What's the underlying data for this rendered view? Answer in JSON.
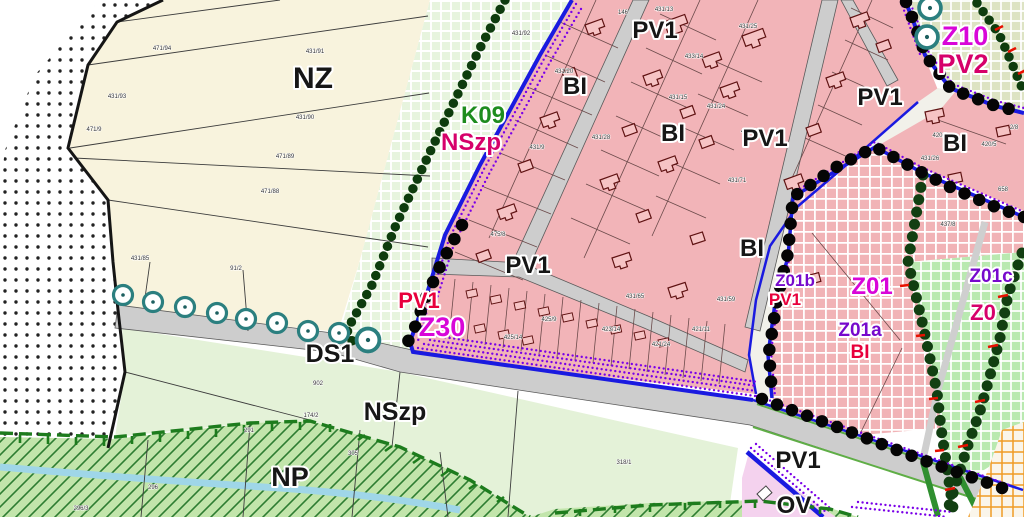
{
  "palette": {
    "pink_zone": "#f2b4b8",
    "cream_zone": "#f8f3dd",
    "green_grid_zone": "#e7f4de",
    "olive_grid_zone": "#dde3c3",
    "bright_green_zone": "#b9e9b0",
    "light_green_zone": "#e4f2d8",
    "hatch_zone": "#c2e5ab",
    "road_gray": "#cdcdcd",
    "boundary_blue": "#1a1ae0",
    "boundary_purple": "#7a00e8",
    "bead_green": "#0e3c0e",
    "tree_teal": "#2b7f7f",
    "tick_red": "#e81000",
    "label_green": "#1e8c1e",
    "label_magenta": "#d806d8",
    "label_crimson": "#d6006a",
    "label_red": "#e8003c",
    "label_purple": "#7709cc",
    "orange_grid": "#ef9b25",
    "stream_blue": "#9fd6e8"
  },
  "zone_labels": [
    {
      "id": "nz",
      "text": "NZ"
    },
    {
      "id": "k09",
      "text": "K09"
    },
    {
      "id": "nszp-colored",
      "text": "NSzp"
    },
    {
      "id": "bi-1",
      "text": "BI"
    },
    {
      "id": "pv1-top",
      "text": "PV1"
    },
    {
      "id": "bi-2",
      "text": "BI"
    },
    {
      "id": "pv1-2",
      "text": "PV1"
    },
    {
      "id": "pv1-3",
      "text": "PV1"
    },
    {
      "id": "bi-3",
      "text": "BI"
    },
    {
      "id": "z10",
      "text": "Z10"
    },
    {
      "id": "pv2",
      "text": "PV2"
    },
    {
      "id": "pv1-junction",
      "text": "PV1"
    },
    {
      "id": "bi-4",
      "text": "BI"
    },
    {
      "id": "pv1-red",
      "text": "PV1"
    },
    {
      "id": "z30",
      "text": "Z30"
    },
    {
      "id": "ds1",
      "text": "DS1"
    },
    {
      "id": "nszp-black",
      "text": "NSzp"
    },
    {
      "id": "np",
      "text": "NP"
    },
    {
      "id": "z01b",
      "text": "Z01b"
    },
    {
      "id": "pv1-red2",
      "text": "PV1"
    },
    {
      "id": "z01",
      "text": "Z01"
    },
    {
      "id": "z01a",
      "text": "Z01a"
    },
    {
      "id": "bi-red",
      "text": "BI"
    },
    {
      "id": "z01c",
      "text": "Z01c"
    },
    {
      "id": "z0",
      "text": "Z0"
    },
    {
      "id": "pv1-bottom",
      "text": "PV1"
    },
    {
      "id": "ov",
      "text": "OV"
    }
  ],
  "parcel_labels": [
    "471/94",
    "431/91",
    "431/93",
    "431/90",
    "471/9",
    "471/89",
    "471/88",
    "431/85",
    "91/2",
    "431/92",
    "146",
    "431/13",
    "431/25",
    "433/14",
    "431/15",
    "431/24",
    "431/28",
    "481/77",
    "431/71",
    "431/20",
    "431/9",
    "475/8",
    "431/65",
    "423/14",
    "425/9",
    "425/14",
    "421/24",
    "421/11",
    "431/59",
    "420/3",
    "420/5",
    "2/8",
    "658",
    "437/8",
    "431/26",
    "902",
    "174/2",
    "318/1",
    "291",
    "296",
    "296/3",
    "305"
  ]
}
